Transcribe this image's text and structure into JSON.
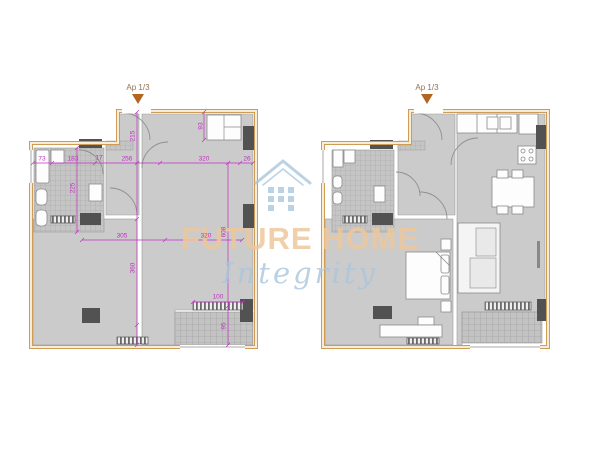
{
  "watermark": {
    "brand": "FUTURE HOME",
    "tagline": "Integrity",
    "brand_color": "#edc89c",
    "tagline_color": "#aac6dd",
    "logo_color": "#a9c7de",
    "logo_icon": "house-icon"
  },
  "plans": {
    "left": {
      "marker_label": "Ap 1/3",
      "dimensions": [
        {
          "t": "73",
          "x": 42,
          "y": 159
        },
        {
          "t": "183",
          "x": 73,
          "y": 159
        },
        {
          "t": "17",
          "x": 99,
          "y": 158
        },
        {
          "t": "256",
          "x": 127,
          "y": 159
        },
        {
          "t": "320",
          "x": 204,
          "y": 159
        },
        {
          "t": "26",
          "x": 247,
          "y": 159
        },
        {
          "t": "305",
          "x": 122,
          "y": 236
        },
        {
          "t": "320",
          "x": 206,
          "y": 236
        },
        {
          "t": "215",
          "x": 133,
          "y": 136,
          "v": true
        },
        {
          "t": "225",
          "x": 73,
          "y": 188,
          "v": true
        },
        {
          "t": "93",
          "x": 201,
          "y": 126,
          "v": true
        },
        {
          "t": "608",
          "x": 224,
          "y": 232,
          "v": true
        },
        {
          "t": "360",
          "x": 133,
          "y": 268,
          "v": true
        },
        {
          "t": "95",
          "x": 224,
          "y": 326,
          "v": true
        },
        {
          "t": "100",
          "x": 218,
          "y": 297
        }
      ]
    },
    "right": {
      "marker_label": "Ap 1/3",
      "dimensions": []
    }
  },
  "colors": {
    "wall_outline": "#cf9c55",
    "dimension_lines": "#c32ec3",
    "marker_triangle": "#b5641f",
    "room_fill": "#cbcbcb",
    "column_fill": "#525252"
  }
}
